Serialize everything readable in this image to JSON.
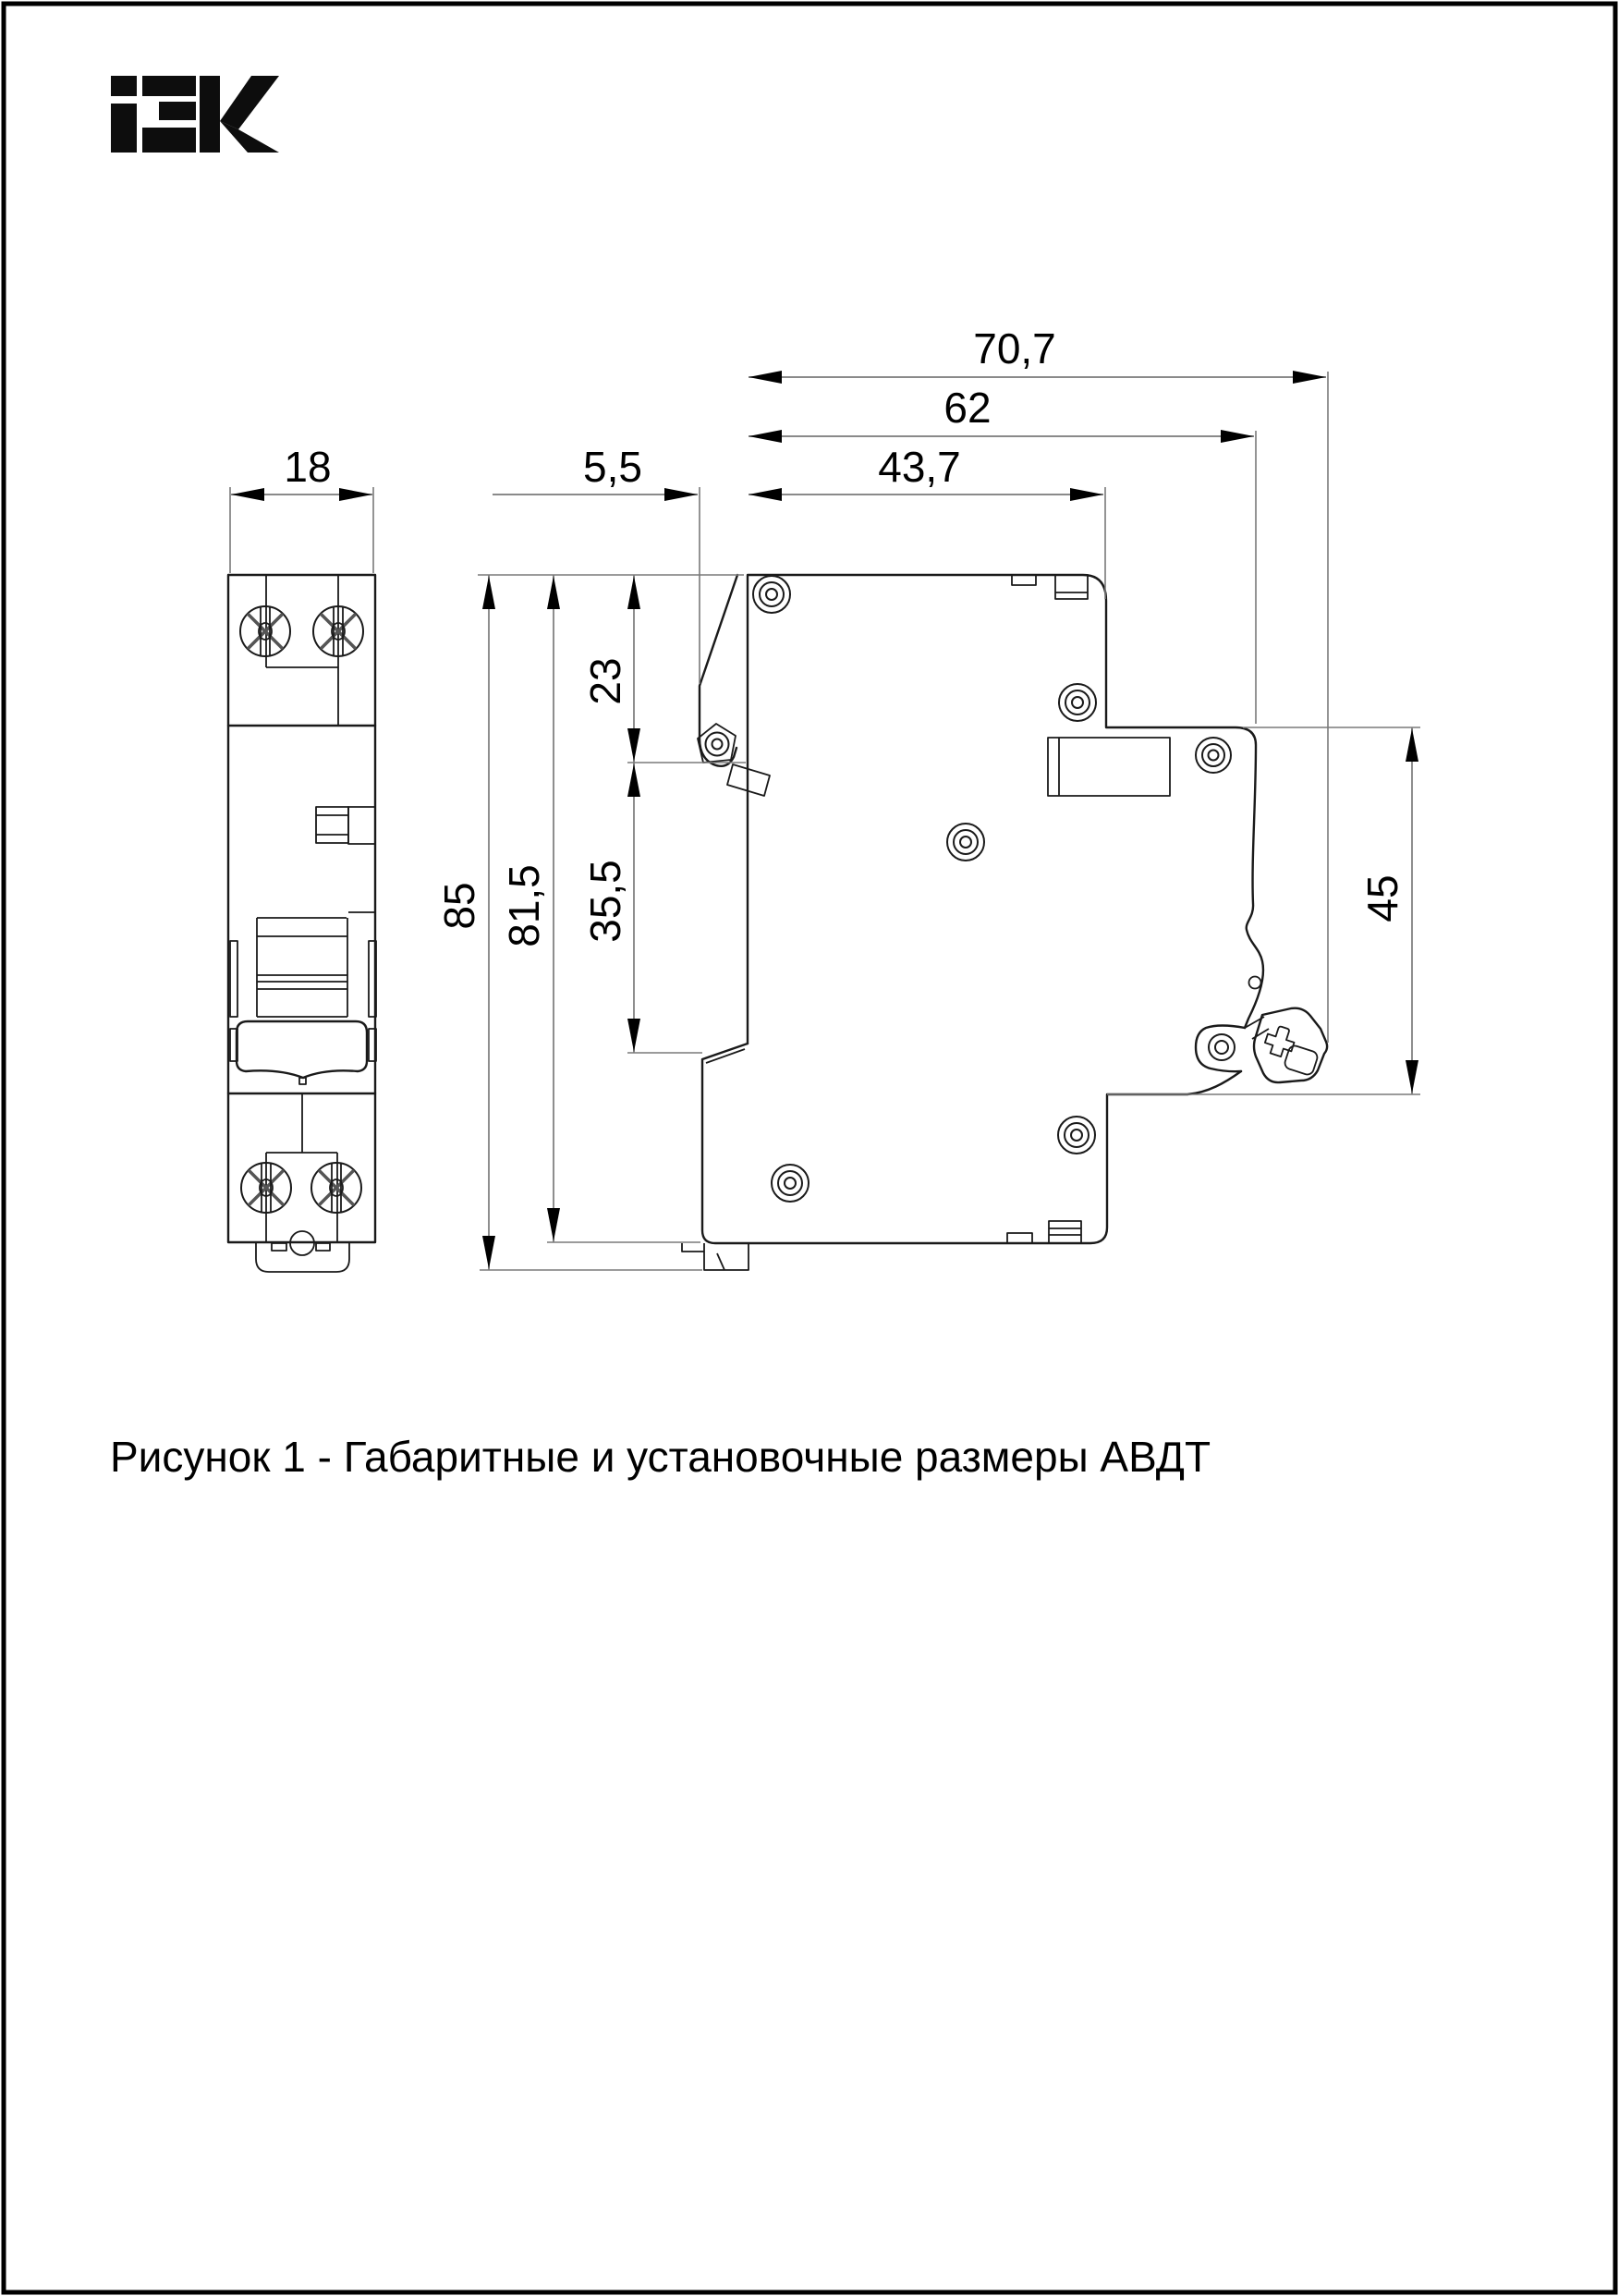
{
  "brand": {
    "logo": "IEK"
  },
  "figure": {
    "caption": "Рисунок 1 - Габаритные и установочные размеры АВДТ",
    "figure_number": "1",
    "subject": "АВДТ"
  },
  "dimensions": {
    "front_width": "18",
    "tab_depth": "5,5",
    "depth_to_step": "43,7",
    "depth_to_din_face": "62",
    "total_depth": "70,7",
    "total_height": "85",
    "body_height": "81,5",
    "top_to_recess": "23",
    "recess_span": "35,5",
    "din_rail_span": "45"
  },
  "colors": {
    "background": "#ffffff",
    "drawing_line": "#1a1a1a",
    "dimension_line": "#7a7a7a",
    "text": "#000000"
  }
}
